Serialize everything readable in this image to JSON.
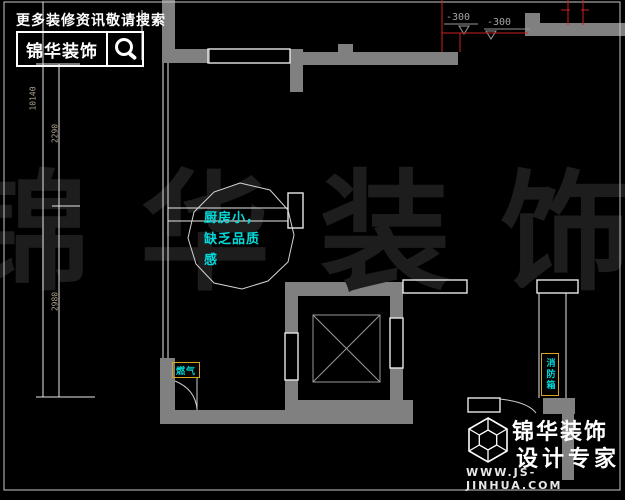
{
  "header": {
    "promo": "更多装修资讯敬请搜索",
    "brand": "锦华装饰"
  },
  "watermark": "锦华装饰",
  "annotations": {
    "kitchen_note": {
      "line1": "厨房小，",
      "line2": "缺乏品质",
      "line3": "感"
    },
    "gas_label": "燃气",
    "fire_box_label": "消防箱"
  },
  "dimensions": {
    "left_total": "10140",
    "left_upper": "2290",
    "left_lower": "2980",
    "elevation_1": "-300",
    "elevation_2": "-300"
  },
  "footer": {
    "brand_line1": "锦华装饰",
    "brand_line2": "设计专家",
    "website": "WWW.JS-JINHUA.COM"
  },
  "colors": {
    "wall": "#808080",
    "red": "#cc2222",
    "cyan": "#00dcdc",
    "yellow": "#d9a521",
    "watermark": "#1d1d1d",
    "line": "#e8e8e8",
    "dimtext": "#b0a48e"
  }
}
